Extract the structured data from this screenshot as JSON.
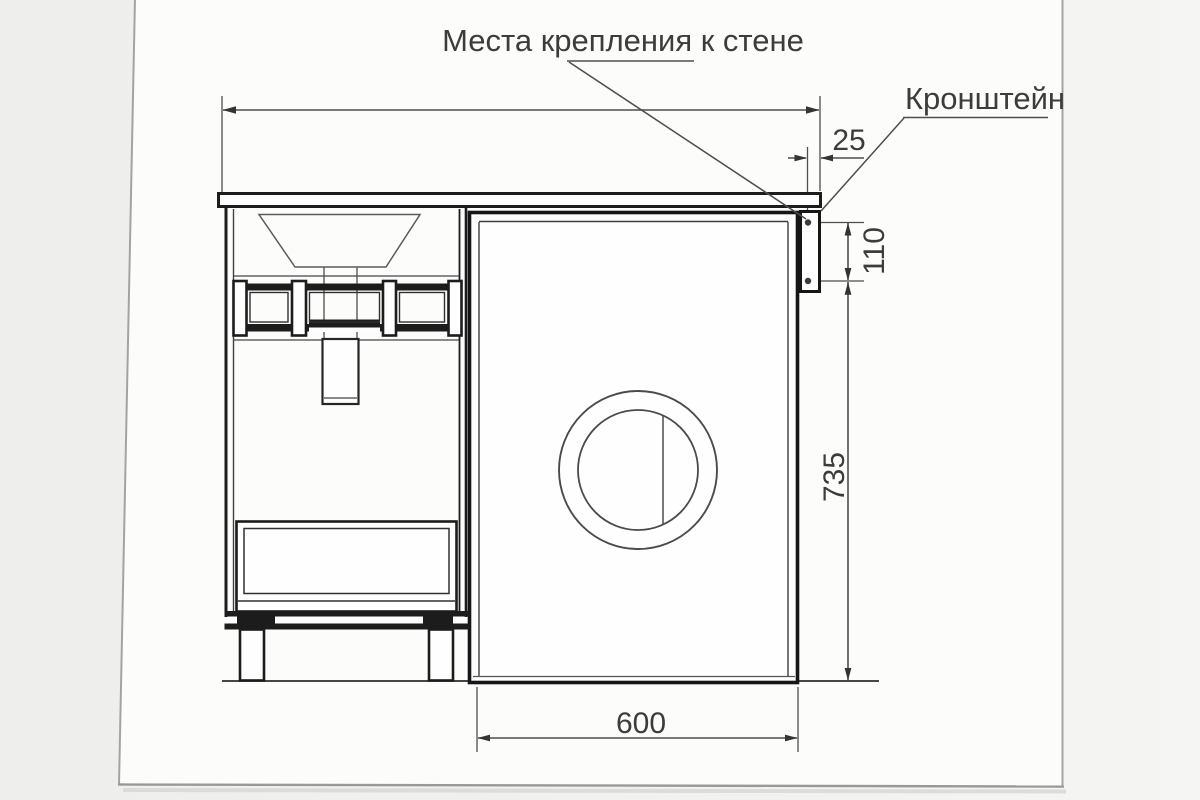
{
  "callouts": {
    "wall_mount_label": "Места крепления к стене",
    "bracket_label": "Кронштейн"
  },
  "dimensions": {
    "countertop_overhang_mm": "25",
    "bracket_hole_spacing_mm": "110",
    "niche_height_mm": "735",
    "niche_width_mm": "600"
  },
  "colors": {
    "furniture_line": "#1b1b1b",
    "dimension_line": "#4d4d4d",
    "text": "#3b3b3b",
    "page_background": "#fdfdfc",
    "outer_background": "#f1f1ef",
    "page_border": "#9e9e9e"
  }
}
